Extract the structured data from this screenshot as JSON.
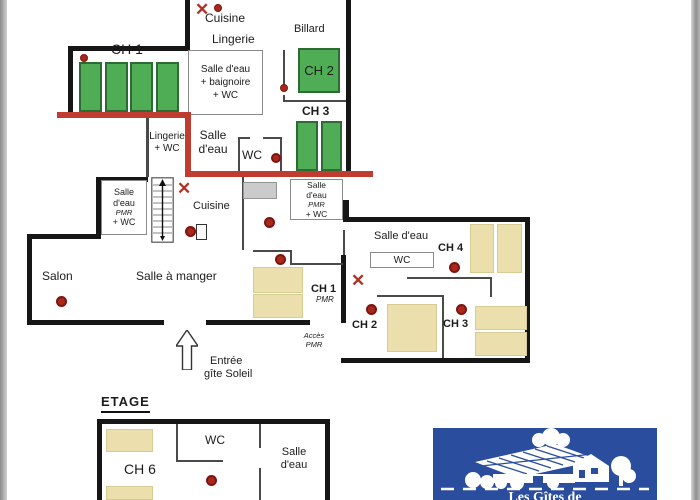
{
  "upper_plan": {
    "cuisine": "Cuisine",
    "lingerie": "Lingerie",
    "billard": "Billard",
    "ch1": "CH 1",
    "ch2": "CH 2",
    "ch3": "CH 3",
    "bath_l1": "Salle d'eau",
    "bath_l2": "+ baignoire",
    "bath_l3": "+ WC",
    "lingerie_wc_l1": "Lingerie",
    "lingerie_wc_l2": "+ WC",
    "salle_eau_l1": "Salle",
    "salle_eau_l2": "d'eau",
    "wc": "WC"
  },
  "ground_plan": {
    "pmr_left": {
      "l1": "Salle",
      "l2": "d'eau",
      "l3": "PMR",
      "l4": "+ WC"
    },
    "pmr_right": {
      "l1": "Salle",
      "l2": "d'eau",
      "l3": "PMR",
      "l4": "+ WC"
    },
    "cuisine": "Cuisine",
    "salon": "Salon",
    "salle_a_manger": "Salle à manger",
    "ch1": "CH 1",
    "ch1_sub": "PMR",
    "acces_l1": "Accès",
    "acces_l2": "PMR",
    "entree_l1": "Entrée",
    "entree_l2": "gîte Soleil",
    "wing": {
      "salle_eau": "Salle d'eau",
      "wc": "WC",
      "ch4": "CH 4",
      "ch2": "CH 2",
      "ch3": "CH 3"
    }
  },
  "etage_plan": {
    "heading": "ETAGE",
    "ch6": "CH 6",
    "wc": "WC",
    "salle_eau_l1": "Salle",
    "salle_eau_l2": "d'eau"
  },
  "logo": {
    "caption": "Les Gîtes de"
  },
  "icons": {
    "x_marker": "✕"
  },
  "colors": {
    "bed_green": "#4fae55",
    "bed_beige": "#ebdfad",
    "marker_red": "#a8281e",
    "separation_red": "#c13c30",
    "wall_black": "#161616",
    "logo_blue": "#2b4d9e"
  }
}
